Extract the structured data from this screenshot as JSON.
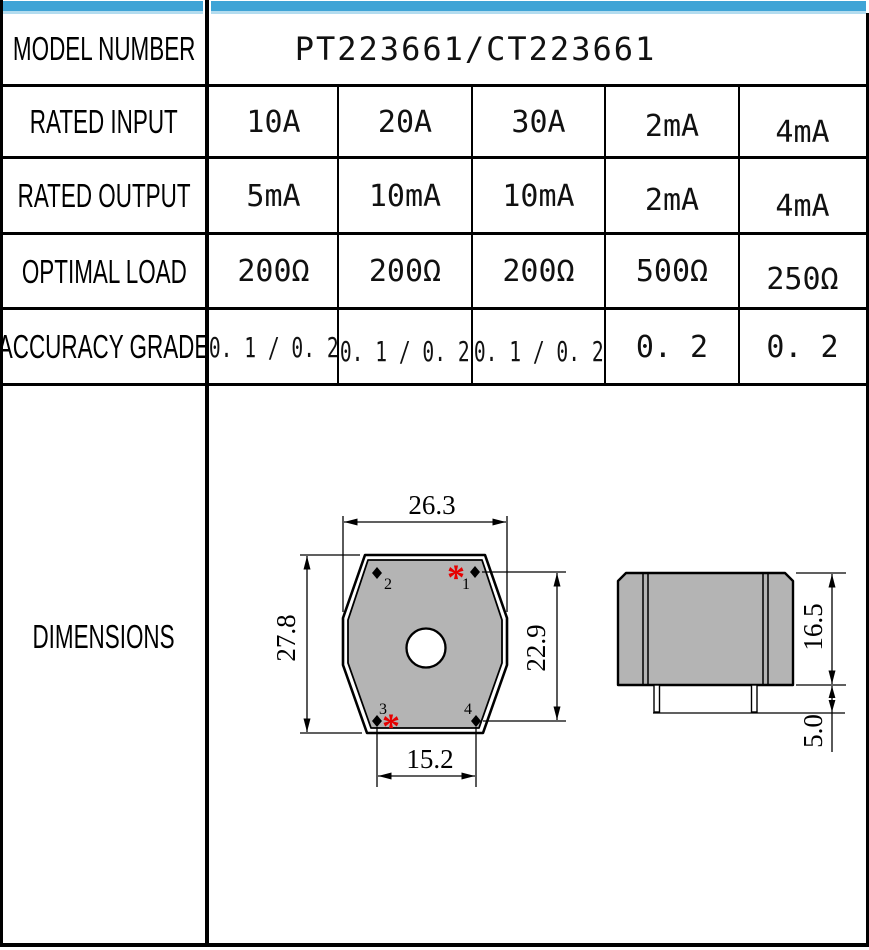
{
  "colors": {
    "header_blue": "#3FA4D6",
    "header_blue_light": "#B3DCEF",
    "part_gray": "#B4B4B4",
    "marker_red": "#E60000"
  },
  "table": {
    "model_row": {
      "label": "MODEL NUMBER",
      "value": "PT223661/CT223661"
    },
    "spec_rows": [
      {
        "label": "RATED INPUT",
        "values": [
          "10A",
          "20A",
          "30A",
          "2mA",
          "4mA"
        ]
      },
      {
        "label": "RATED OUTPUT",
        "values": [
          "5mA",
          "10mA",
          "10mA",
          "2mA",
          "4mA"
        ]
      },
      {
        "label": "OPTIMAL LOAD",
        "values": [
          "200Ω",
          "200Ω",
          "200Ω",
          "500Ω",
          "250Ω"
        ]
      },
      {
        "label": "ACCURACY GRADE",
        "values": [
          "0. 1 / 0. 2",
          "0. 1 / 0. 2",
          "0. 1 / 0. 2",
          "0. 2",
          "0. 2"
        ]
      }
    ],
    "dimensions_row": {
      "label": "DIMENSIONS"
    }
  },
  "drawing": {
    "front_view": {
      "width_top": "26.3",
      "height_left": "27.8",
      "height_right": "22.9",
      "width_bottom": "15.2",
      "pin_labels": {
        "p1": "1",
        "p2": "2",
        "p3": "3",
        "p4": "4"
      },
      "polarity_mark": "*"
    },
    "side_view": {
      "body_height": "16.5",
      "pin_length": "5.0"
    }
  }
}
